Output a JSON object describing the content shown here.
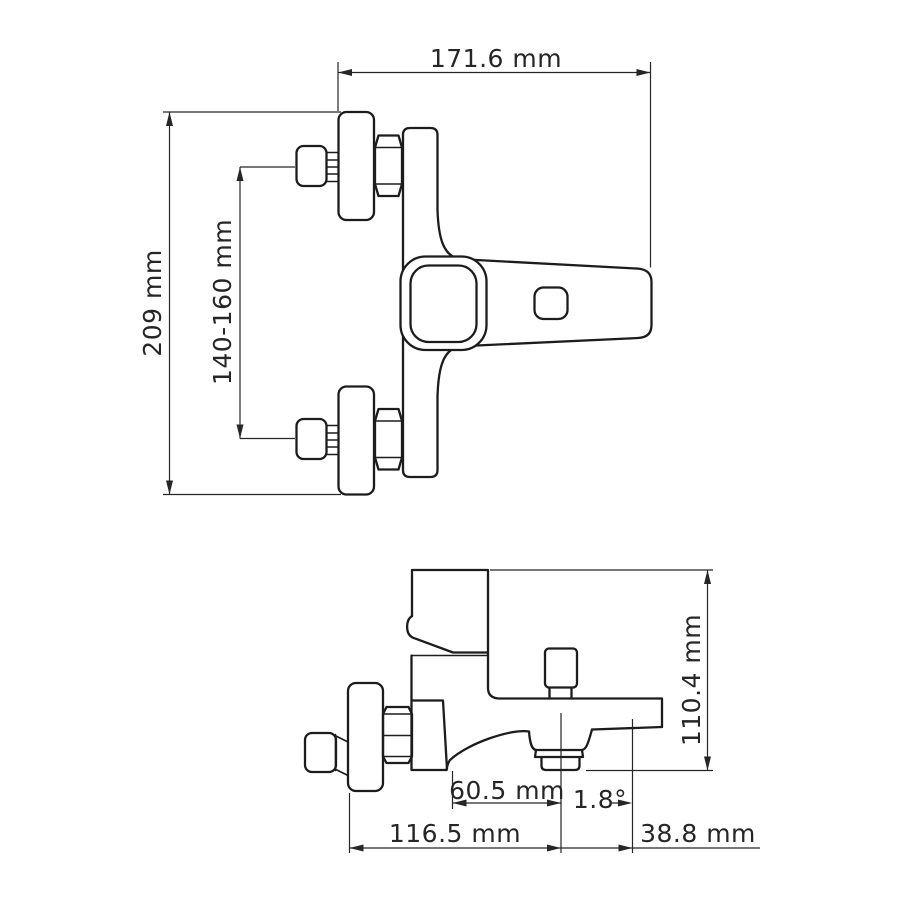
{
  "colors": {
    "line": "#1c1c1c",
    "dim": "#262626",
    "background": "#ffffff"
  },
  "views": {
    "front": {
      "dims": {
        "width": "171.6 mm",
        "height": "209 mm",
        "mount_spacing": "140-160 mm"
      }
    },
    "side": {
      "dims": {
        "height": "110.4 mm",
        "spout_offset": "60.5 mm",
        "spout_angle": "1.8°",
        "depth": "116.5 mm",
        "tip_length": "38.8 mm"
      }
    }
  }
}
